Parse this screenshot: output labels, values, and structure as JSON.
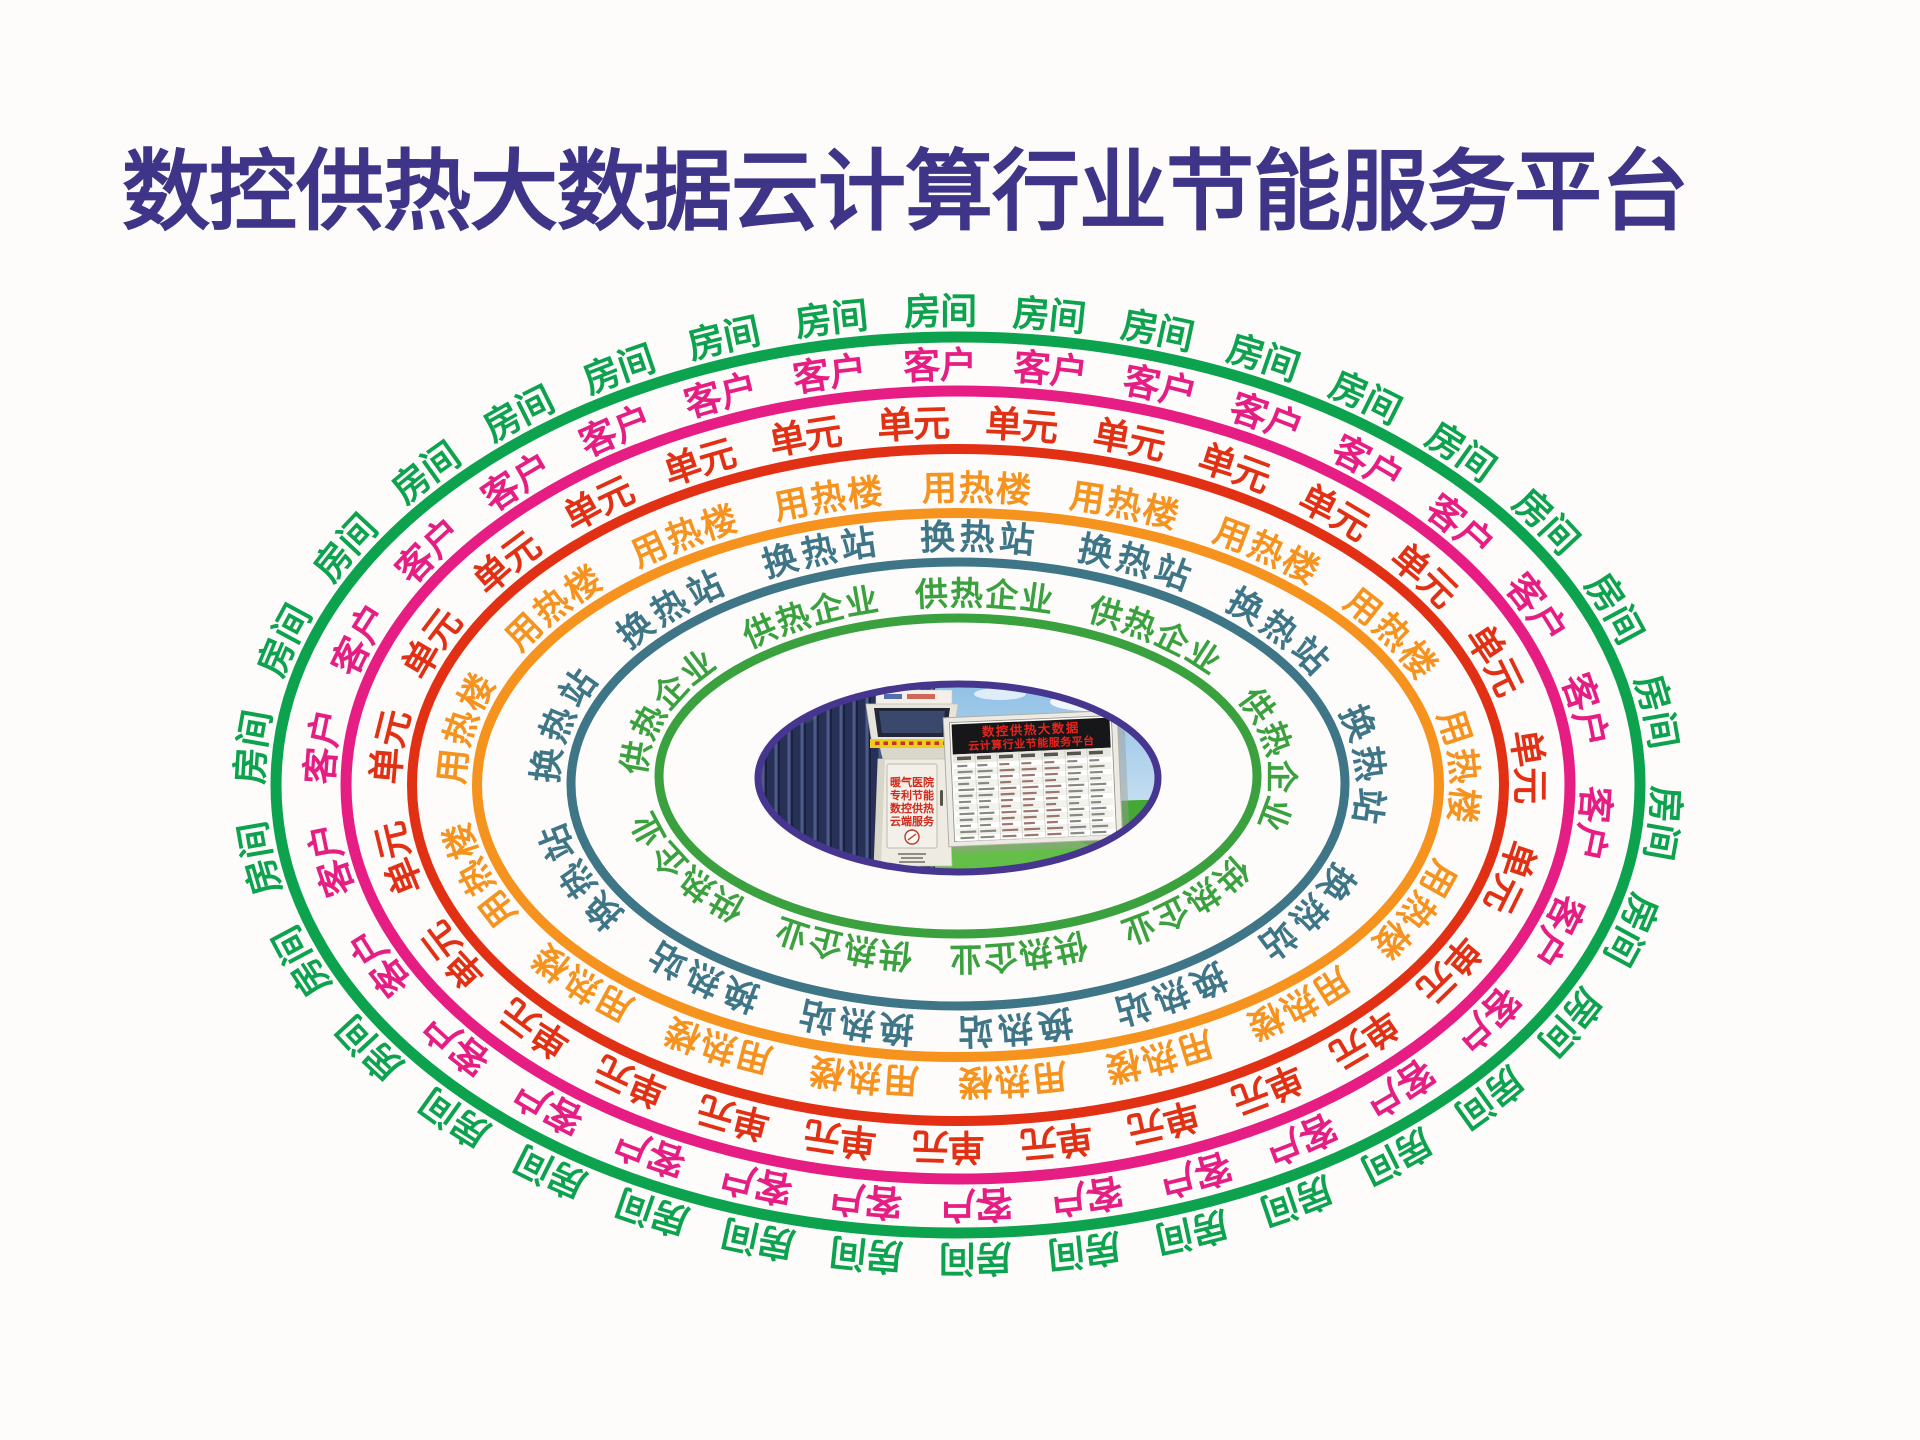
{
  "title": {
    "text": "数控供热大数据云计算行业节能服务平台",
    "color": "#3e3488"
  },
  "rings": [
    {
      "name": "rooms",
      "label": "房间",
      "color": "#0ca24e",
      "count": 34
    },
    {
      "name": "customers",
      "label": "客户",
      "color": "#e61d82",
      "count": 30
    },
    {
      "name": "units",
      "label": "单元",
      "color": "#e23014",
      "count": 27
    },
    {
      "name": "heat-use-buildings",
      "label": "用热楼",
      "color": "#f6921e",
      "count": 17
    },
    {
      "name": "heat-exchange-stations",
      "label": "换热站",
      "color": "#3e7587",
      "count": 13
    },
    {
      "name": "heating-enterprises",
      "label": "供热企业",
      "color": "#3aa13e",
      "count": 9
    }
  ],
  "center": {
    "border_color": "#47368f",
    "kiosk": {
      "door_lines": [
        "暖气医院",
        "专利节能",
        "数控供热",
        "云端服务"
      ],
      "door_text_color": "#cf2a1c"
    },
    "board": {
      "title_lines": [
        "数控供热大数据",
        "云计算行业节能服务平台"
      ],
      "title_color": "#e8251c"
    }
  }
}
